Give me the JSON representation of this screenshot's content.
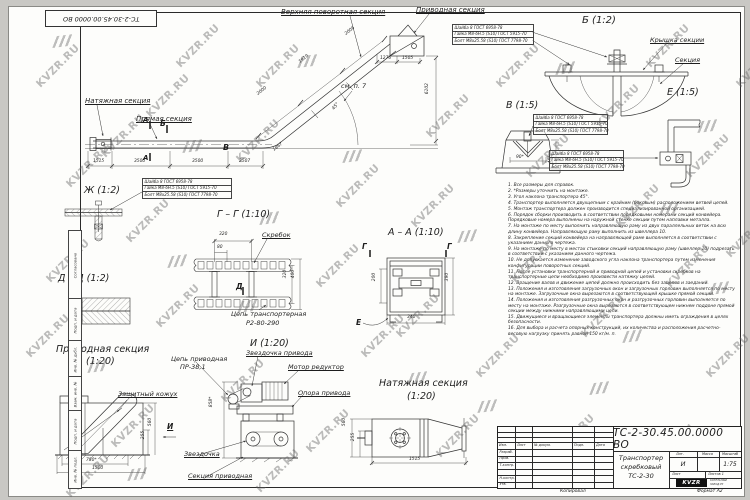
{
  "sheet": {
    "corner_stamp": "ТС-2-30.45.00.0000 ВО",
    "kopiroval_label": "Копировал",
    "format_label": "Формат А2",
    "margin_labels": [
      "Согласовано",
      "Подп. и дата",
      "Инв. № дубл.",
      "Взам. инв. №",
      "Подп. и дата",
      "Инв. № подл."
    ]
  },
  "watermark": {
    "text": "KVZR.RU"
  },
  "fastener_note": {
    "lines": [
      "Шайба 8 ГОСТ 6958-78",
      "Гайка М8-6Н.5 (S10) ГОСТ 5915-70",
      "Болт М8х25.58 (S10) ГОСТ 7798-70"
    ]
  },
  "annotations": [
    {
      "name": "natyazhnaya-label",
      "text": "Натяжная секция"
    },
    {
      "name": "pryamaya-label",
      "text": "Прямая секция"
    },
    {
      "name": "verhnyaya-povorotnaya-label",
      "text": "Верхняя поворотная секция"
    },
    {
      "name": "privodnaya-sektsiya-top-label",
      "text": "Приводная секция"
    },
    {
      "name": "sm-p7-label",
      "text": "см. п. 7"
    },
    {
      "name": "dim-1515-main",
      "text": "1515"
    },
    {
      "name": "dim-3500-a",
      "text": "3500"
    },
    {
      "name": "dim-3500-b",
      "text": "3500"
    },
    {
      "name": "dim-2507",
      "text": "2507"
    },
    {
      "name": "dim-1867",
      "text": "1867"
    },
    {
      "name": "dim-2000",
      "text": "2000"
    },
    {
      "name": "dim-1919",
      "text": "1919"
    },
    {
      "name": "dim-2006",
      "text": "2006"
    },
    {
      "name": "dim-6102",
      "text": "6102"
    },
    {
      "name": "dim-1276",
      "text": "1276"
    },
    {
      "name": "dim-1505",
      "text": "1505"
    },
    {
      "name": "angle-45-main",
      "text": "45°"
    },
    {
      "name": "marker-a-top",
      "text": "А"
    },
    {
      "name": "marker-a-bottom",
      "text": "А"
    },
    {
      "name": "marker-b",
      "text": "Б"
    },
    {
      "name": "marker-v",
      "text": "В"
    },
    {
      "name": "zh-detail-label",
      "text": "Ж (1:2)"
    },
    {
      "name": "dd-detail-label",
      "text": "Д – Д (1:2)"
    },
    {
      "name": "privodnaya-view-label",
      "text": "Приводная секция"
    },
    {
      "name": "privodnaya-view-scale",
      "text": "(1:20)"
    },
    {
      "name": "zashchitny-kozhuh-label",
      "text": "Защитный кожух"
    },
    {
      "name": "dim-780",
      "text": "780*"
    },
    {
      "name": "dim-1500",
      "text": "1500"
    },
    {
      "name": "dim-255-ps",
      "text": "255"
    },
    {
      "name": "dim-560-ps",
      "text": "560"
    },
    {
      "name": "marker-i-view",
      "text": "И"
    },
    {
      "name": "gg-label",
      "text": "Г – Г (1:10)"
    },
    {
      "name": "skrebok-label",
      "text": "Скребок"
    },
    {
      "name": "dim-320-top",
      "text": "320"
    },
    {
      "name": "dim-80",
      "text": "80"
    },
    {
      "name": "dim-320-right",
      "text": "320"
    },
    {
      "name": "dim-400",
      "text": "400"
    },
    {
      "name": "marker-d",
      "text": "Д"
    },
    {
      "name": "tsep-transp-label-1",
      "text": "Цепь транспортерная"
    },
    {
      "name": "tsep-transp-label-2",
      "text": "Р2-80-290"
    },
    {
      "name": "aa-label",
      "text": "А – А (1:10)"
    },
    {
      "name": "marker-g-left",
      "text": "Г"
    },
    {
      "name": "marker-g-right",
      "text": "Г"
    },
    {
      "name": "marker-e-aa",
      "text": "Е"
    },
    {
      "name": "dim-200",
      "text": "200"
    },
    {
      "name": "dim-390",
      "text": "390"
    },
    {
      "name": "dim-340",
      "text": "340"
    },
    {
      "name": "i-view-label",
      "text": "И (1:20)"
    },
    {
      "name": "tsep-privodnaya-label-1",
      "text": "Цепь приводная"
    },
    {
      "name": "tsep-privodnaya-label-2",
      "text": "ПР-38,1"
    },
    {
      "name": "zvezdochka-privoda-label",
      "text": "Звездочка привода"
    },
    {
      "name": "motor-reduktor-label",
      "text": "Мотор редуктор"
    },
    {
      "name": "opora-privoda-label",
      "text": "Опора привода"
    },
    {
      "name": "dim-858",
      "text": "858*"
    },
    {
      "name": "zvezdochka-label",
      "text": "Звездочка"
    },
    {
      "name": "sektsiya-privodnaya-label",
      "text": "Секция приводная"
    },
    {
      "name": "natyazhnaya-view-label",
      "text": "Натяжная секция"
    },
    {
      "name": "natyazhnaya-view-scale",
      "text": "(1:20)"
    },
    {
      "name": "dim-560-ns",
      "text": "560"
    },
    {
      "name": "dim-255-ns",
      "text": "255"
    },
    {
      "name": "dim-1515-ns",
      "text": "1515"
    },
    {
      "name": "b-detail-label",
      "text": "Б (1:2)"
    },
    {
      "name": "kryshka-sektsii-label",
      "text": "Крышка секции"
    },
    {
      "name": "sektsiya-label",
      "text": "Секция"
    },
    {
      "name": "v-detail-label",
      "text": "В (1:5)"
    },
    {
      "name": "dim-90",
      "text": "90*"
    },
    {
      "name": "dim-45-v",
      "text": "45°"
    },
    {
      "name": "e-detail-label",
      "text": "Е (1:5)"
    }
  ],
  "notes": [
    "1. Все размеры для справок.",
    "2. *Размеры уточнить на монтаже.",
    "3. Угол наклона транспортера 45°.",
    "4. Транспортер выполняется двухцепным с крайним (боковым) расположением ветвей цепей.",
    "5. Монтаж транспортера должен производится специализированной организацией.",
    "6. Порядок сборки производить в соответствии порядковыми номерами секций конвейера. Порядковые номера выполнены на наружной стенке секции путем наплавки металла.",
    "7. На монтаже по месту выполнить направляющую раму из двух параллельных веток на всю длину конвейера. Направляющую раму выполнить из швеллера 10.",
    "8. Закрепление секций конвейера на направляющей раме выполняется в соответствии с указанием данного чертежа.",
    "9. На монтаже по месту в местах стыковки секций направляющую раму (швеллер 10) подрезать в соответствии с указанием данного чертежа.",
    "10. Не допускается изменение заводского угла наклона транспортера путем изменения конфигурации поворотных секций.",
    "11. После установки транспортерной и приводной цепей и установки скребков на транспортерные цепи необходимо произвести натяжку цепей.",
    "12. Вращение валов и движение цепей должно происходить без зацепов и заеданий.",
    "13. Положения и изготовления загрузочных окон и загрузочных горловин выполняется по месту на монтаже. Загрузочные окна вырезаются в соответствующей крышке прямой секции.",
    "14. Положения и изготовления разгрузочных окон и разгрузочных горловин выполняется по месту на монтаже. Разгрузочные окна вырезаются в соответствующем нижнем поддоне прямой секции между нижними направляющими цепи.",
    "15. Движущиеся и вращающиеся элементы транспортера должны иметь ограждения в целях безопасности.",
    "16. Для выбора и расчета опорных конструкций, их количества и расположения расчетно-весовую нагрузку принять равной 150 кг/м. п."
  ],
  "titleblock": {
    "doc_number": "ТС-2-30.45.00.0000 ВО",
    "title_lines": [
      "Транспортер",
      "скребковый",
      "ТС-2-30"
    ],
    "header_cols": [
      "Изм.",
      "Лист",
      "№ докум.",
      "Подп.",
      "Дата"
    ],
    "sign_rows": [
      "Разраб.",
      "Пров.",
      "Т.контр.",
      "",
      "Н.контр.",
      "Утв."
    ],
    "lit_label": "Лит.",
    "mass_label": "Масса",
    "scale_label": "Масштаб",
    "lit_value": "И",
    "scale_value": "1:75",
    "sheet_label": "Лист",
    "sheets_label": "Листов 1",
    "logo_text": "KVZR",
    "logo_sub_lines": [
      "КОТЕЛЬНЫЙ",
      "ЗАВОД.РУ"
    ]
  }
}
